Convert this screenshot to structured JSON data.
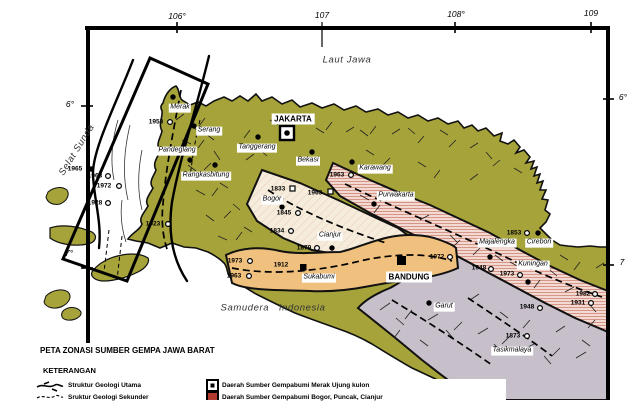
{
  "title": "PETA ZONASI SUMBER GEMPA JAWA BARAT",
  "legend": {
    "heading": "KETERANGAN",
    "struktur_utama": "Struktur Geologi Utama",
    "struktur_sekunder": "Sruktur Geologi Sekunder",
    "zone_merak": "Daerah Sumber Gempabumi Merak Ujung kulon",
    "zone_bogor": "Daerah Sumber Gempabumi Bogor, Puncak, Cianjur"
  },
  "graticule": {
    "top106": "106°",
    "top107": "107",
    "top108": "108°",
    "top109": "109",
    "left6": "6°",
    "left7": "7°",
    "right6": "6°",
    "right7": "7"
  },
  "waters": {
    "laut_jawa": "Laut Jawa",
    "selat_sunda": "Selat Sunda",
    "samudera": "Samudera   Indonesia"
  },
  "cities": {
    "merak": "Merak",
    "serang": "Serang",
    "pandeglang": "Pandeglang",
    "rangkasbitung": "Rangkasbitung",
    "jakarta": "JAKARTA",
    "tanggerang": "Tanggerang",
    "bekasi": "Bekasi",
    "karawang": "Karawang",
    "purwakarta": "Purwakarta",
    "bogor": "Bogor",
    "cianjur": "Cianjur",
    "sukabumi": "Sukabumi",
    "bandung": "BANDUNG",
    "majalengka": "Majalengka",
    "cirebon": "Cirebon",
    "kuningan": "Kuningan",
    "garut": "Garut",
    "tasikmalaya": "Tasikmalaya"
  },
  "years": {
    "y1953": "1953",
    "y1965": "1965",
    "y1963a": "1963",
    "y1972a": "1972",
    "y1928": "1928",
    "y1923": "1923",
    "y1963b": "1963",
    "y1963c": "1963",
    "y1833": "1833",
    "y1845": "1845",
    "y1834": "1834",
    "y1879": "1879",
    "y1973a": "1973",
    "y1912": "1912",
    "y1963d": "1963",
    "y1972b": "1972",
    "y1948a": "1948",
    "y1973b": "1973",
    "y1853": "1853",
    "y1982": "1982",
    "y1931": "1931",
    "y1948b": "1948",
    "y1873": "1873"
  },
  "colors": {
    "sea": "#ffffff",
    "land": "#a6a33a",
    "outline": "#111111",
    "zone_merak_fill": "#ffffff",
    "zone_bogor_fill": "#f6ecdc",
    "zone_bogor_hatch": "#e0b9a6",
    "zone_sukabumi_fill": "#f0c17e",
    "zone_north_fill": "#f2d9d2",
    "zone_north_hatch": "#cc7766",
    "zone_garut_fill": "#c7bfca",
    "legend_box2": "#b23a2e"
  }
}
